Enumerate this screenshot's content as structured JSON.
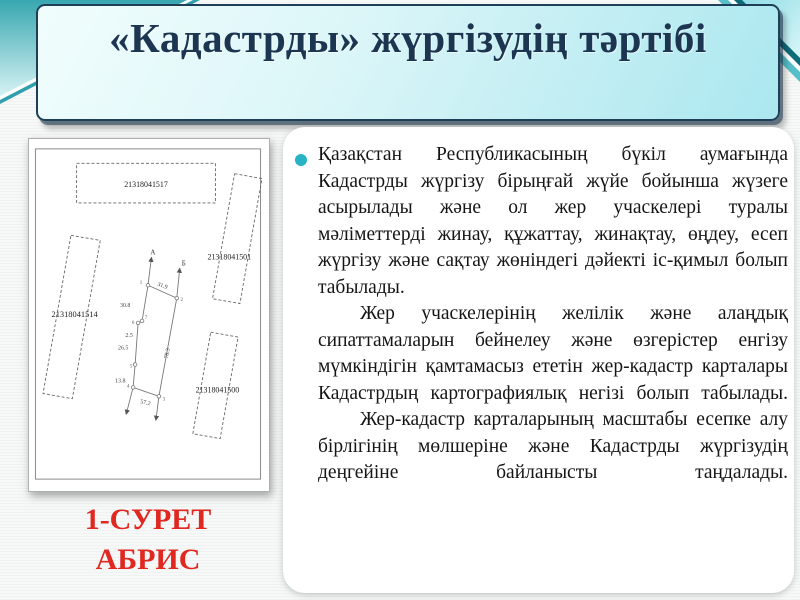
{
  "slide": {
    "title": "«Кадастрды» жүргізудің тәртібі"
  },
  "figure": {
    "caption": {
      "line1": "1-СУРЕТ",
      "line2": "АБРИС"
    },
    "abris": {
      "parcels": {
        "top": "21318041517",
        "right": "21318041501",
        "left": "21318041514",
        "bottom_right": "21318041500"
      },
      "measurements": {
        "top_edge": "31.9",
        "seg_1_7": "30.8",
        "seg_7_6": "2.5",
        "seg_6_5": "26.5",
        "seg_5_4": "13.8",
        "right_edge": "78.3",
        "bottom_edge": "57.2"
      },
      "points": {
        "p1": "1",
        "p2": "2",
        "p3": "3",
        "p4": "4",
        "p5": "5",
        "p6": "6",
        "p7": "7"
      },
      "axes": {
        "a": "А",
        "b": "Б"
      }
    }
  },
  "body": {
    "paragraphs": [
      "Қазақстан Республикасының бүкіл аумағында Кадастрды жүргізу бірыңғай жүйе бойынша жүзеге асырылады және ол жер учаскелері туралы мәліметтерді жинау, құжаттау, жинақтау, өңдеу, есеп жүргізу және сақтау жөніндегі дәйекті іс-қимыл болып табылады.",
      "Жер учаскелерінің желілік және алаңдық сипаттамаларын бейнелеу және өзгерістер енгізу мүмкіндігін қамтамасыз ететін жер-кадастр карталары Кадастрдың картографиялық негізі болып табылады.",
      "Жер-кадастр карталарының масштабы есепке алу бірлігінің мөлшеріне және Кадастрды жүргізудің деңгейіне байланысты таңдалады."
    ]
  },
  "colors": {
    "title_navy": "#1c3551",
    "caption_red": "#e02720",
    "bullet_cyan": "#27b3c4",
    "accent_teal": "#2da2ae",
    "title_box_cyan": "#abe7ef"
  }
}
